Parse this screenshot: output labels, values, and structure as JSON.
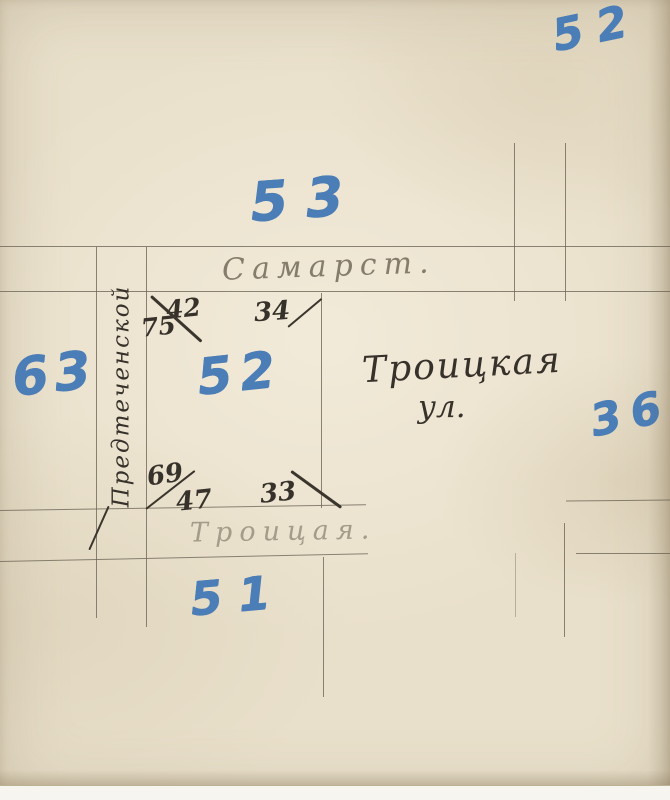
{
  "blocks": {
    "top_right": "52",
    "north": "53",
    "west": "63",
    "center": "52",
    "east": "36",
    "south": "51"
  },
  "streets": {
    "top": "Самарст.",
    "left_vertical": "Предтеченской",
    "bottom": "Троицая.",
    "annotation_line1": "Троицкая",
    "annotation_line2": "ул."
  },
  "house_numbers": {
    "nw_upper": "42",
    "nw_lower": "75",
    "ne": "34",
    "sw_upper": "69",
    "sw_lower": "47",
    "se": "33"
  },
  "colors": {
    "paper": "#e9e0cb",
    "blue_crayon": "#4b7db6",
    "ink": "#36312a",
    "pencil_line": "#6c6456",
    "pencil_text_dark": "#857c6b",
    "pencil_text_light": "#a49b8a"
  }
}
